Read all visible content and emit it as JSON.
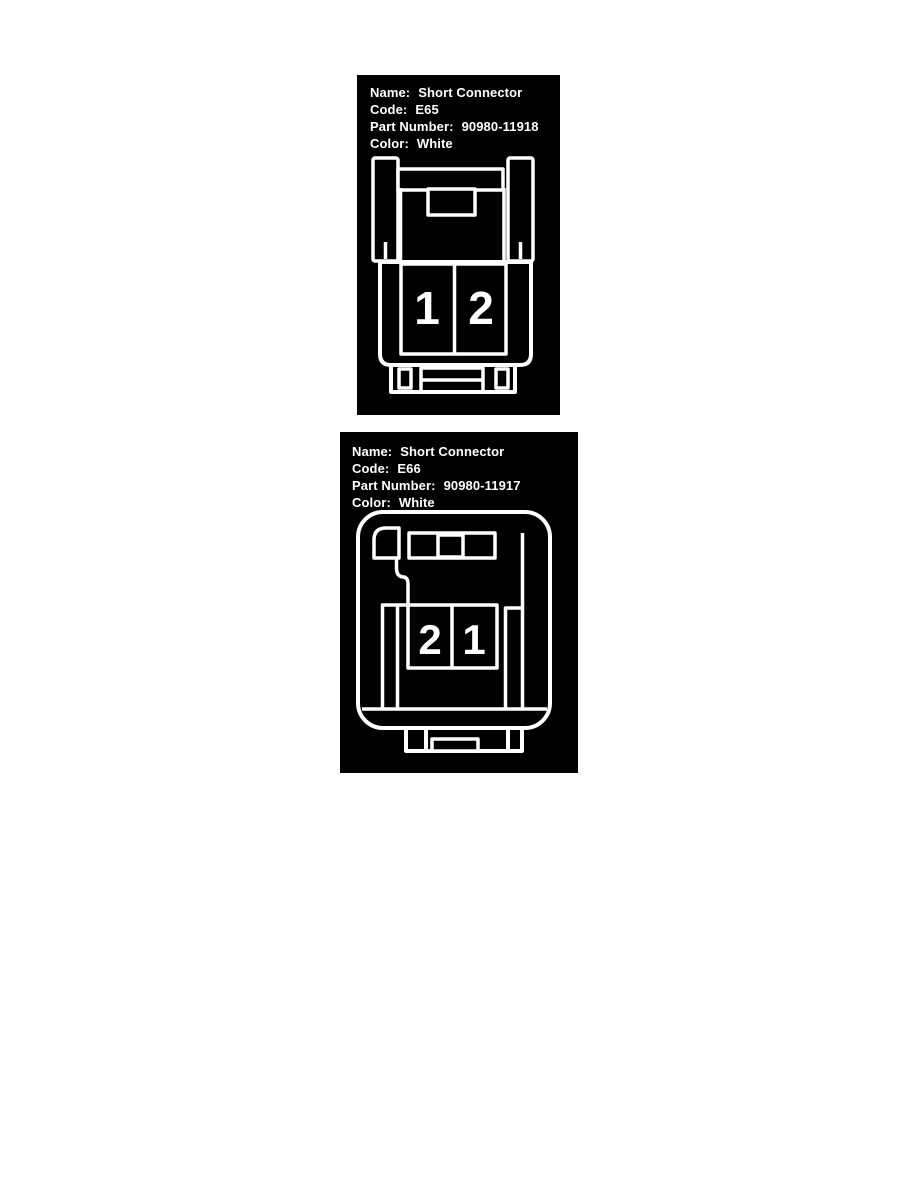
{
  "page": {
    "background": "#ffffff"
  },
  "colors": {
    "panel_bg": "#000000",
    "line": "#ffffff",
    "text": "#ffffff"
  },
  "field_labels": {
    "name": "Name:",
    "code": "Code:",
    "part": "Part Number:",
    "color": "Color:"
  },
  "connectors": [
    {
      "name": "Short Connector",
      "code": "E65",
      "part_number": "90980-11918",
      "color": "White",
      "cavities": [
        "1",
        "2"
      ]
    },
    {
      "name": "Short Connector",
      "code": "E66",
      "part_number": "90980-11917",
      "color": "White",
      "cavities": [
        "2",
        "1"
      ]
    }
  ]
}
